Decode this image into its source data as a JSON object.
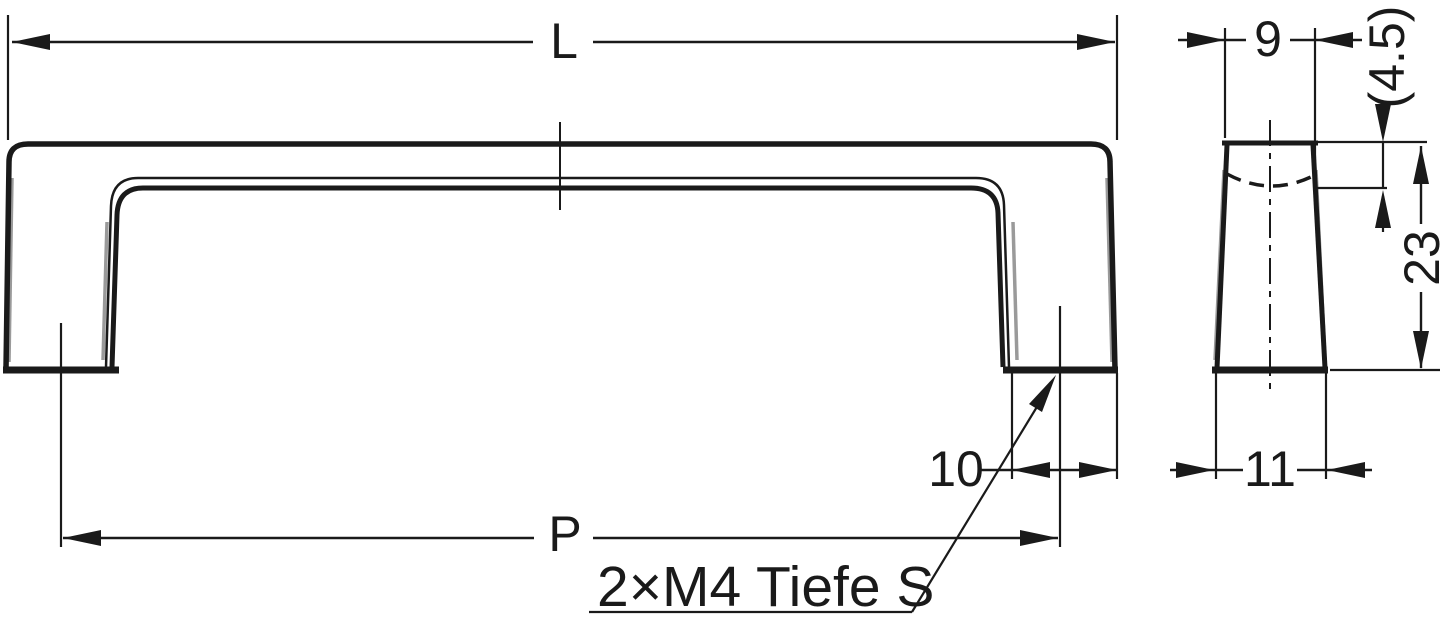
{
  "colors": {
    "ink": "#1a1a1a",
    "shade": "#9a9a9a",
    "paper": "#ffffff"
  },
  "drawing": {
    "kind": "technical-dimension-drawing",
    "views": {
      "front": "handle-front-view",
      "side": "handle-side-profile-view"
    },
    "dimensions": {
      "overall_length": {
        "label": "L"
      },
      "hole_pitch": {
        "label": "P"
      },
      "foot_width": {
        "label": "10"
      },
      "profile_top_width": {
        "label": "9"
      },
      "profile_bottom_width": {
        "label": "11"
      },
      "profile_height": {
        "label": "23"
      },
      "top_wall_thickness": {
        "label": "(4.5)"
      }
    },
    "note": {
      "text": "2×M4 Tiefe S"
    }
  }
}
